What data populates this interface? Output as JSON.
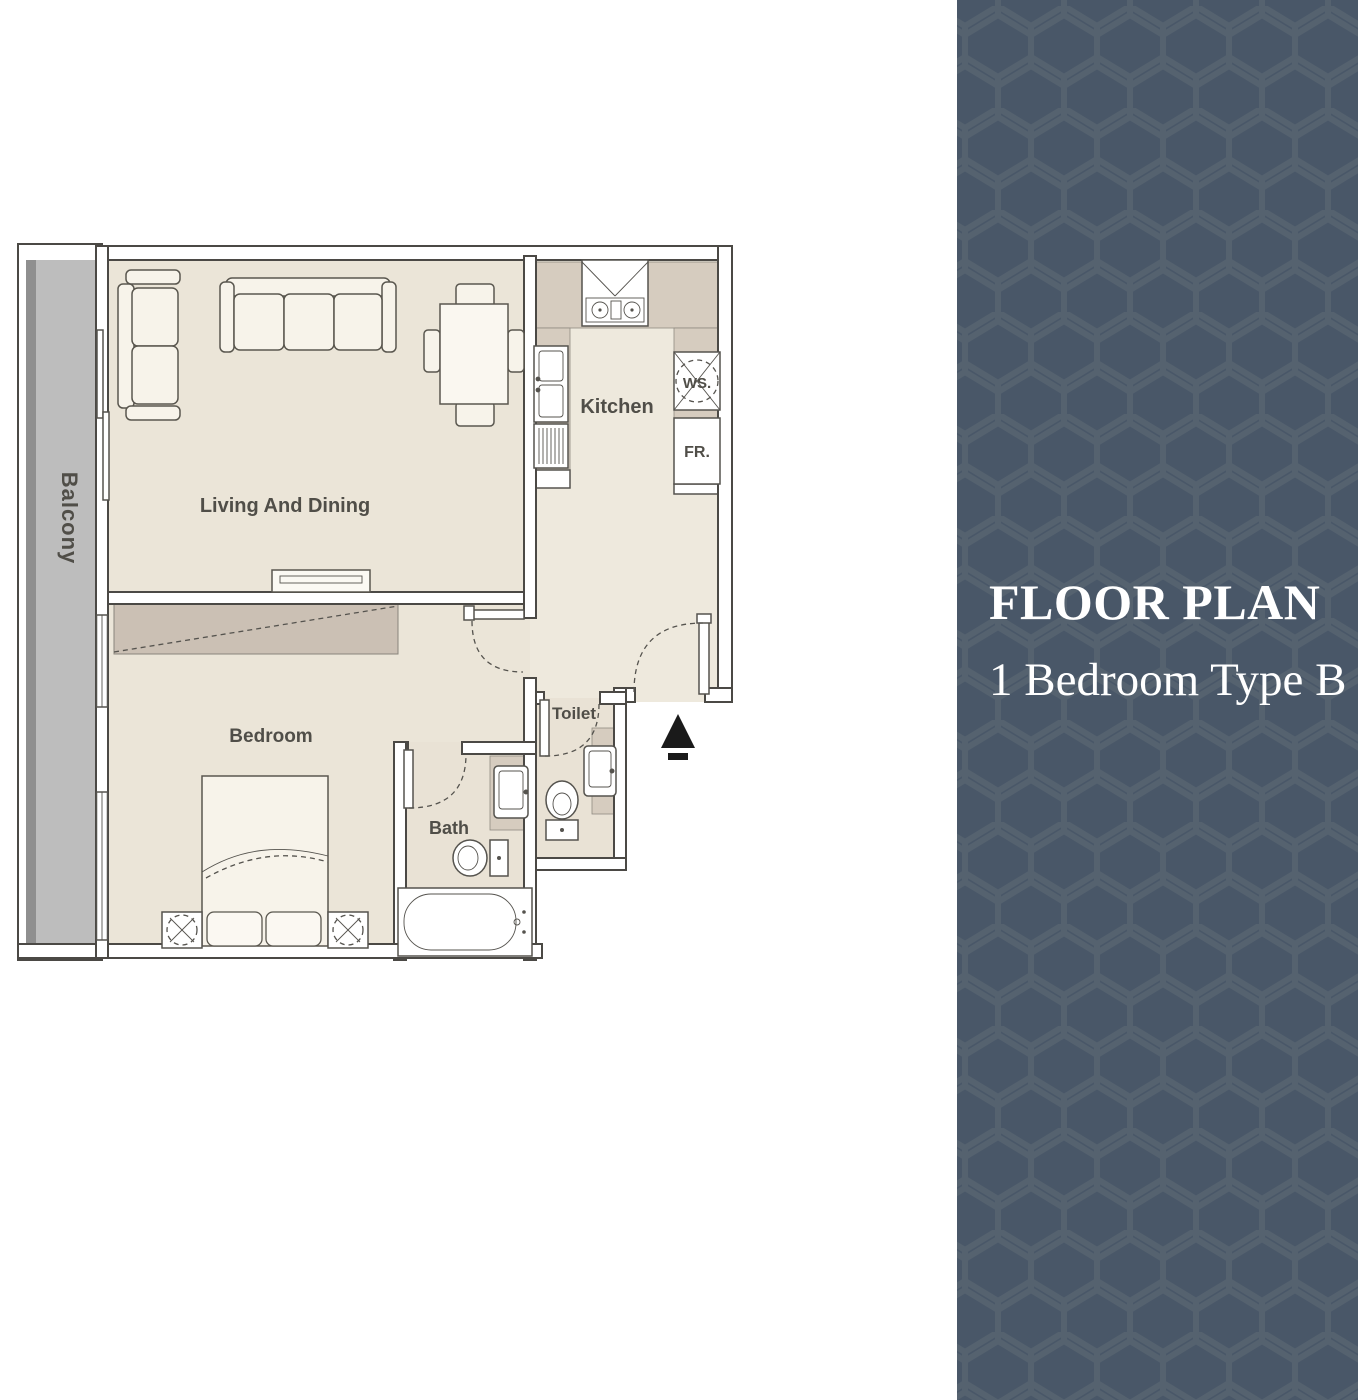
{
  "panel": {
    "title": "FLOOR PLAN",
    "subtitle": "1 Bedroom Type B",
    "background_color": "#495768",
    "pattern_color": "#55626f",
    "pattern": "hexagon-lattice",
    "text_color": "#ffffff"
  },
  "plan": {
    "rooms": [
      {
        "label": "Living And Dining"
      },
      {
        "label": "Kitchen"
      },
      {
        "label": "Bedroom"
      },
      {
        "label": "Bath"
      },
      {
        "label": "Toilet"
      },
      {
        "label": "Balcony"
      }
    ],
    "appliances": [
      {
        "label": "WS."
      },
      {
        "label": "FR."
      }
    ],
    "furniture": [
      "sofa-three-seat",
      "loveseat",
      "dining-table-four-chairs",
      "tv-console",
      "wardrobe",
      "double-bed",
      "nightstand-lamp-left",
      "nightstand-lamp-right",
      "kitchen-stove",
      "kitchen-sink",
      "dish-rack",
      "bath-sink",
      "bath-toilet",
      "bathtub",
      "toilet-sink",
      "toilet-wc",
      "entrance-marker"
    ],
    "colors": {
      "floor": "#ebe5d8",
      "kitchen_floor": "#eee9dd",
      "wet_floor": "#e9e2d5",
      "counter": "#d6ccbf",
      "balcony": "#bdbdbd",
      "balcony_edge": "#8f8f8f",
      "wall_line": "#4b4945",
      "wardrobe": "#cbc0b4",
      "label_text": "#504e48",
      "entrance_marker": "#1a1a1a"
    }
  }
}
